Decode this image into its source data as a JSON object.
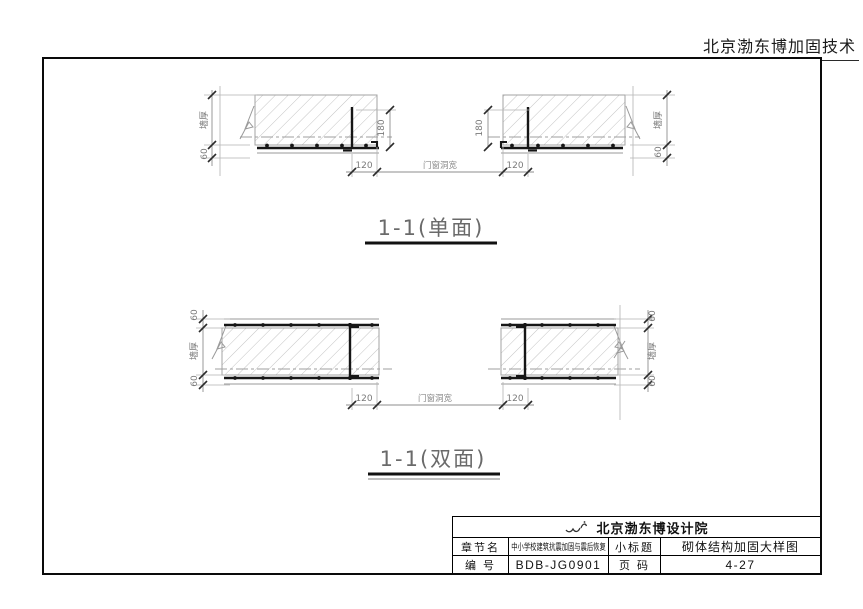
{
  "header": {
    "company": "北京渤东博加固技术"
  },
  "sections": {
    "single": {
      "title": "1-1(单面)"
    },
    "double": {
      "title": "1-1(双面)"
    }
  },
  "dims": {
    "wall_thickness": "墙厚",
    "layer_60": "60",
    "anchor_180": "180",
    "edge_120": "120",
    "opening_width": "门窗洞宽"
  },
  "title_block": {
    "institute": "北京渤东博设计院",
    "logo_icon": "institute-logo",
    "chapter_label": "章节名",
    "chapter_value": "中小学校建筑抗震加固与震后恢复",
    "subtitle_label": "小标题",
    "subtitle_value": "砌体结构加固大样图",
    "number_label": "编 号",
    "number_value": "BDB-JG0901",
    "page_label": "页 码",
    "page_value": "4-27"
  },
  "colors": {
    "ink": "#1a1a1a",
    "hatch": "#bdbdbd",
    "dim_text": "#7a7a7a"
  }
}
